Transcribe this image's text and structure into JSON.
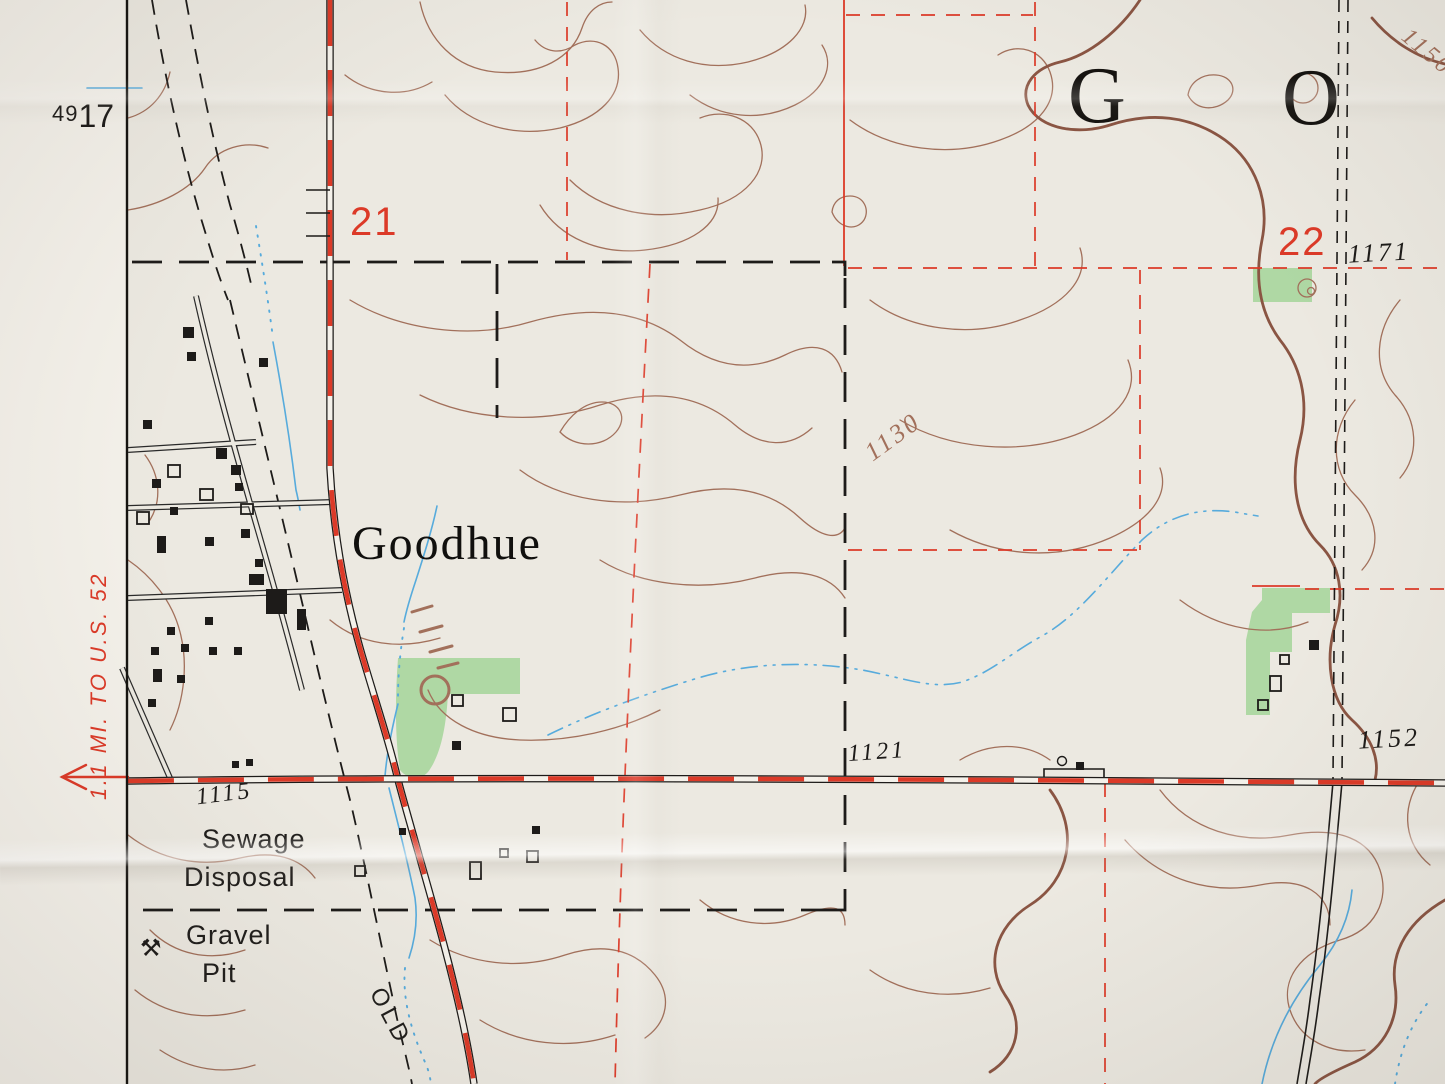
{
  "colors": {
    "paper": "#ece9e1",
    "margin_paper": "#f4f1ea",
    "contour_brown": "#a2705b",
    "index_brown": "#8a5543",
    "ink": "#1d1b19",
    "red": "#dc3a28",
    "green": "#afd8a4",
    "water": "#57abdc",
    "town_gray": "#2a2a2a"
  },
  "marginalia": {
    "grid_label_small": "49",
    "grid_label_large": "17",
    "road_destination_note": "1.1 MI. TO U.S. 52",
    "arrow_icon": "left-continuation-arrow"
  },
  "map_labels": {
    "town_name": "Goodhue",
    "township_letter_g": "G",
    "township_letter_o": "O",
    "section_number_21": "21",
    "section_number_22": "22",
    "sewage_disposal_line1": "Sewage",
    "sewage_disposal_line2": "Disposal",
    "gravel_pit_line1": "Gravel",
    "gravel_pit_line2": "Pit",
    "gravel_pit_glyph": "⚒",
    "old_grade_label": "OLD"
  },
  "elevations": {
    "spot_1171": "1171",
    "contour_1130": "1130",
    "contour_1150": "1150",
    "spot_1121": "1121",
    "spot_1152": "1152",
    "spot_1115": "1115"
  }
}
